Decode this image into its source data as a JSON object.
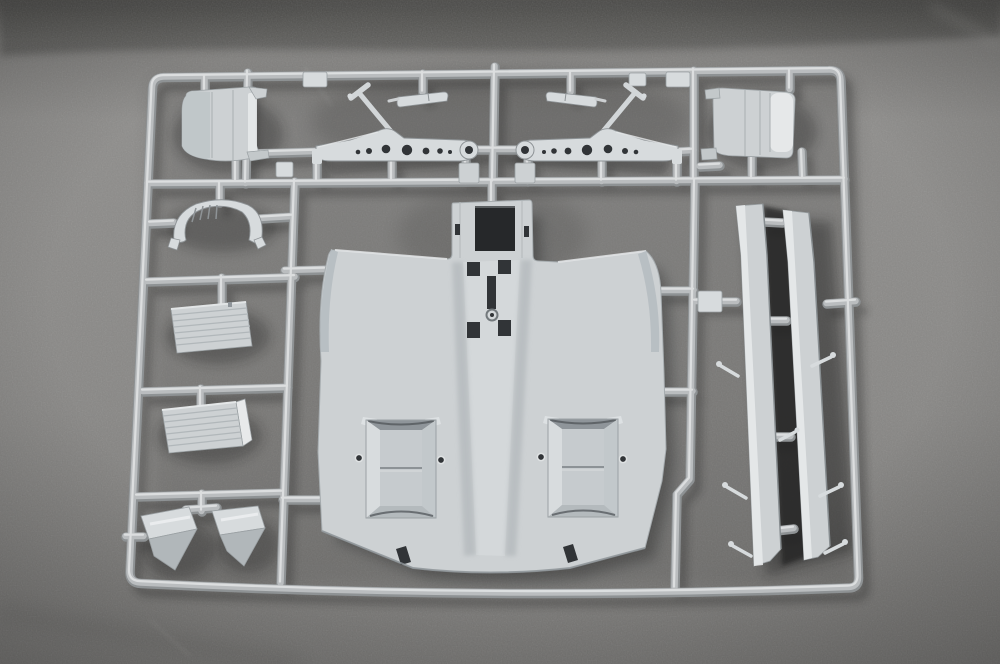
{
  "scene": {
    "type": "photograph",
    "subject": "Injection-molded light gray plastic model-kit sprue with unassembled parts",
    "surface": "dark gray speckled fabric",
    "plastic_color_name": "light gray",
    "parts": [
      {
        "id": "sprue-frame",
        "label": "Rectangular sprue runner frame with internal rails"
      },
      {
        "id": "cowl-panel-left",
        "label": "Curved cowl panel, top-left cell"
      },
      {
        "id": "cowl-panel-right",
        "label": "Curved cowl panel, top-right cell"
      },
      {
        "id": "spar-arm-left",
        "label": "Perforated tapered spar arm with diagonal strut and ring end (left)"
      },
      {
        "id": "spar-arm-right",
        "label": "Perforated tapered spar arm with diagonal strut and ring end (right, mirrored)"
      },
      {
        "id": "linkage-bar-left",
        "label": "Small linkage bar above left spar arm"
      },
      {
        "id": "linkage-bar-right",
        "label": "Small linkage bar above right spar arm"
      },
      {
        "id": "frame-arch",
        "label": "Arched frame piece with short ribs"
      },
      {
        "id": "louvered-box-upper",
        "label": "Louvered rectangular panel, upper left column"
      },
      {
        "id": "louvered-box-lower",
        "label": "Louvered rectangular panel, lower left column"
      },
      {
        "id": "intake-wedge-left",
        "label": "Wedge-shaped intake scoop (left)"
      },
      {
        "id": "intake-wedge-right",
        "label": "Wedge-shaped intake scoop (right)"
      },
      {
        "id": "fuselage-panel",
        "label": "Large fuselage/wing panel with nose opening, slot cluster and two vent recesses"
      },
      {
        "id": "blade-strip-inner",
        "label": "Long blade strip with attachment pins (inner)"
      },
      {
        "id": "blade-strip-outer",
        "label": "Long blade strip with attachment pins (outer)"
      }
    ]
  },
  "colors": {
    "bg-top": "#4e4d4b",
    "bg-upper": "#7c7b79",
    "bg-mid": "#8e8d8b",
    "bg-low": "#888785",
    "bg-bottom": "#757472",
    "runner-body": "#babdbf",
    "runner-hi": "#e0e2e3",
    "runner-shade": "#8e9294",
    "part-face": "#cdd1d3",
    "part-light": "#d7dbdd",
    "part-hi": "#e7e9ea",
    "part-shade": "#b1b7ba",
    "part-deep": "#8f959a",
    "opening": "#26282a",
    "hole": "#313437",
    "edge": "#9aa0a3",
    "shadow": "#141412"
  }
}
